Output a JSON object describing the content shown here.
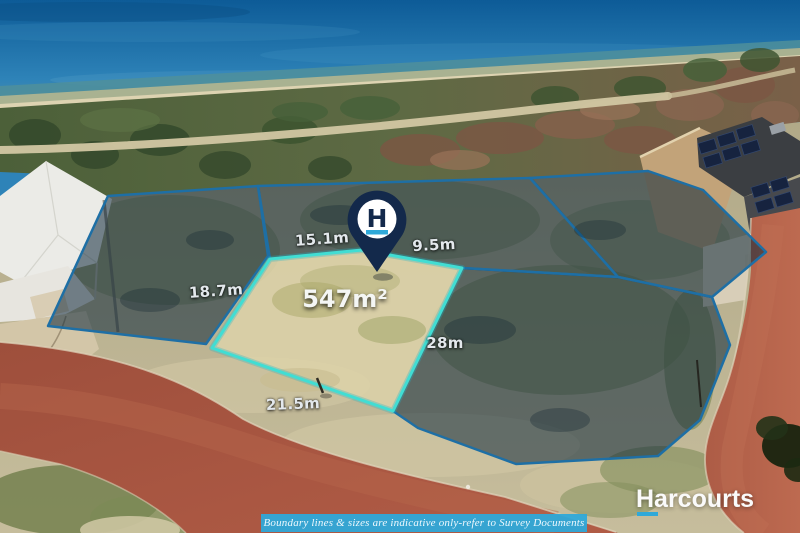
{
  "branding": {
    "agency_name": "Harcourts",
    "logo_letter": "H",
    "accent_cyan": "#2fa9d9",
    "navy": "#13294b"
  },
  "lot": {
    "area_label": "547m²",
    "measurements": {
      "top_left": "15.1m",
      "top_right": "9.5m",
      "left": "18.7m",
      "right": "28m",
      "bottom": "21.5m"
    },
    "highlight_border_color": "#41ddd3",
    "neighbor_border_color": "#1e6fa5"
  },
  "disclaimer": {
    "text": "Boundary lines & sizes are indicative only-refer to Survey Documents"
  }
}
